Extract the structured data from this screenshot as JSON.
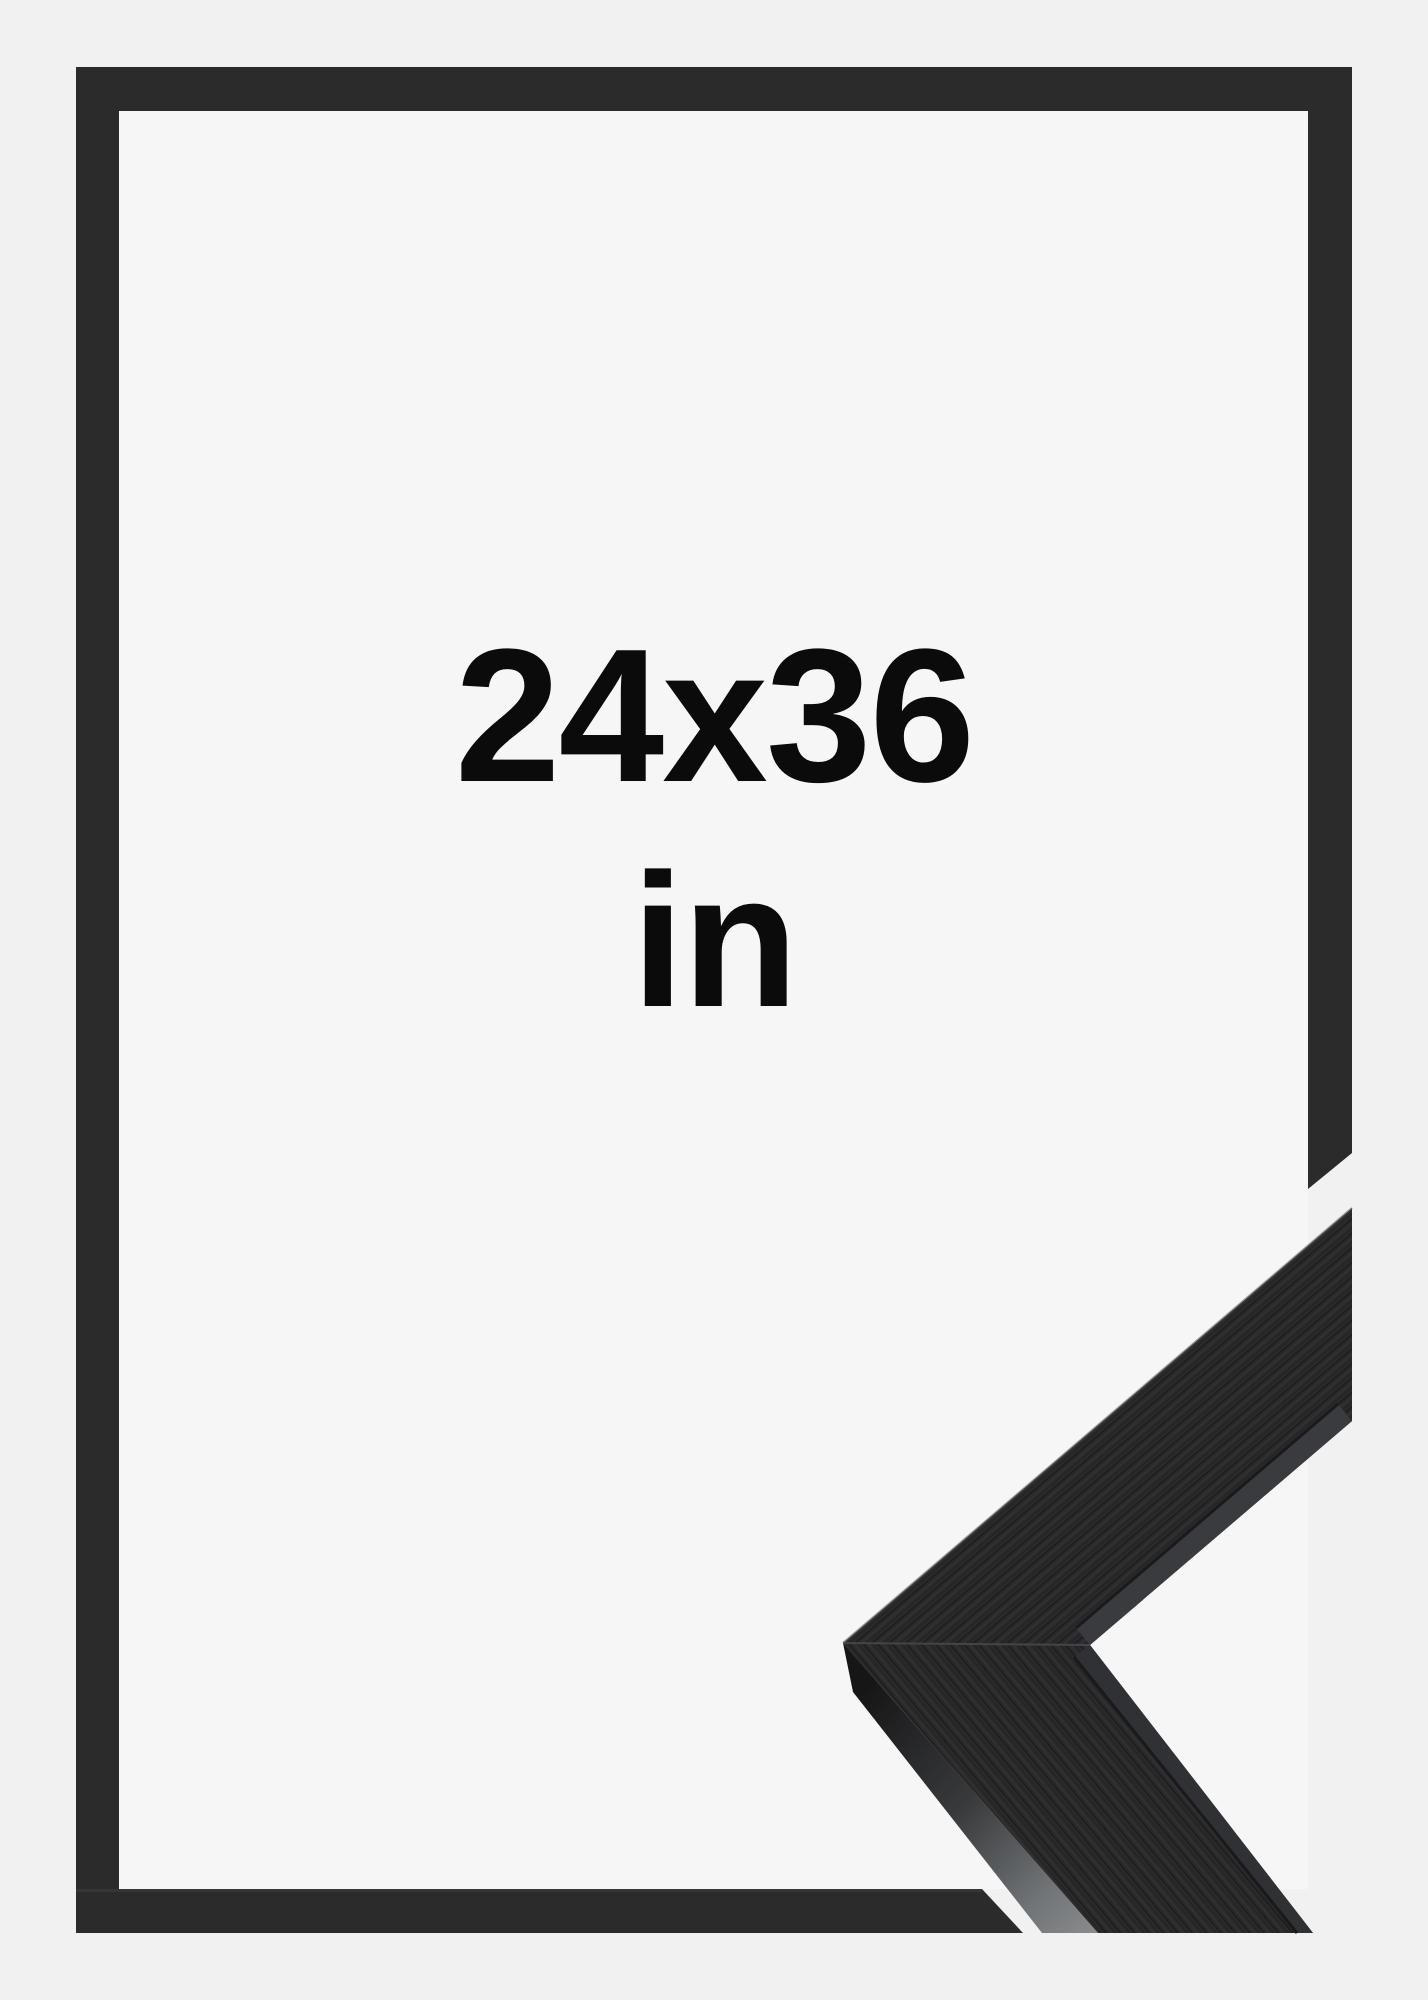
{
  "size_label": {
    "dimensions": "24x36",
    "unit": "in"
  },
  "colors": {
    "page_background": "#f1f1f2",
    "matte": "#f6f6f7",
    "frame": "#2b2b2c",
    "frame_edge_highlight": "#3e3e40",
    "sample_surface": "#2a2a2b",
    "sample_lip_upper": "#3a3b3e",
    "sample_lip_lower": "#303134",
    "sample_lip_seam": "#1a1a1c",
    "sample_side_dark": "#161617",
    "sample_side_light": "#888c8f",
    "label_text": "#0b0b0b"
  }
}
